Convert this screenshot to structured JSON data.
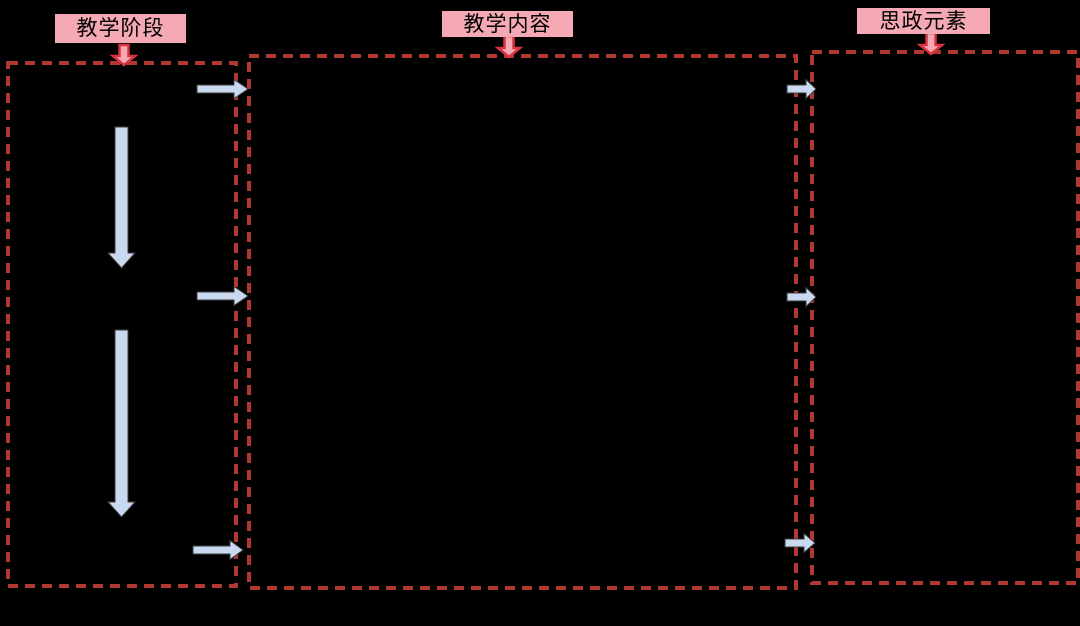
{
  "canvas": {
    "width": 1080,
    "height": 626,
    "background": "#000000"
  },
  "labels": {
    "teaching_stage": "教学阶段",
    "teaching_content": "教学内容",
    "civic_elements": "思政元素"
  },
  "colors": {
    "label_bg": "#f4a9b5",
    "label_text": "#000000",
    "box_border": "#b03830",
    "red_arrow_stroke": "#d93340",
    "red_arrow_fill": "#f4a9b5",
    "blue_arrow_fill": "#c8d9f0",
    "blue_arrow_stroke": "#3d3d3d"
  },
  "icons": {
    "red_down_arrow": "⇓",
    "blue_down_arrow": "⬇",
    "blue_right_arrow": "➡"
  }
}
